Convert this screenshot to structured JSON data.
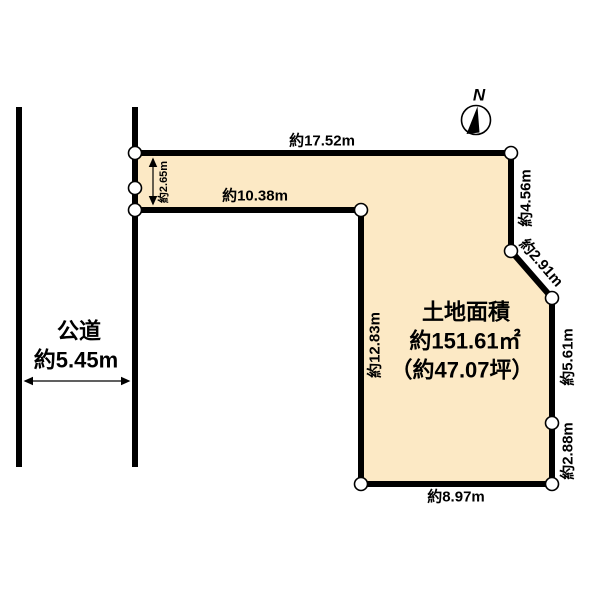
{
  "diagram": {
    "background_color": "#ffffff",
    "outline_color": "#000000",
    "compass": {
      "north_label": "N"
    },
    "road": {
      "name": "公道",
      "width_label": "約5.45m"
    },
    "plot": {
      "fill_color": "#fce9c5",
      "area": {
        "title": "土地面積",
        "size_label": "約151.61㎡",
        "tsubo_label": "（約47.07坪）"
      },
      "dimensions": {
        "top": "約17.52m",
        "strip_inner": "約10.38m",
        "strip_depth": "約2.65m",
        "inner_vertical": "約12.83m",
        "right_upper": "約4.56m",
        "diagonal": "約2.91m",
        "right_middle": "約5.61m",
        "right_lower": "約2.88m",
        "bottom": "約8.97m"
      }
    }
  }
}
